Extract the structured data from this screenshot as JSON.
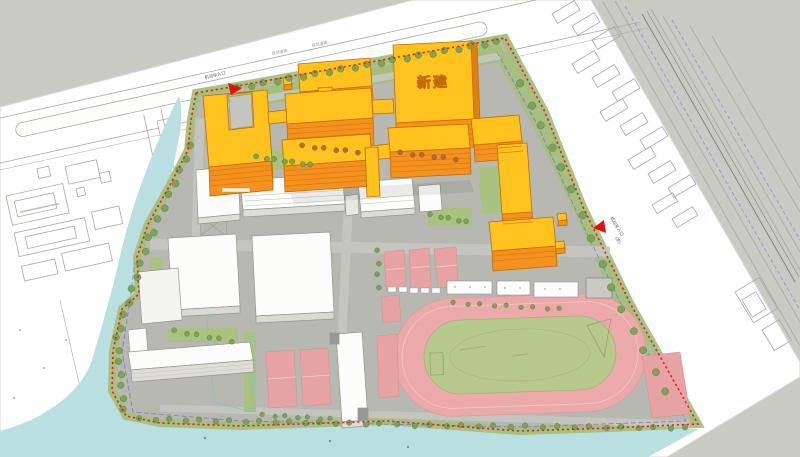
{
  "plan": {
    "type": "campus-master-plan-axonometric",
    "labels": {
      "new_building": "新建",
      "entrance_top": "机动车入口",
      "road_label_1": "规划道路",
      "road_label_2": "规划道路",
      "entrance_right": "机动车入口",
      "entrance_right_note": "(次)"
    },
    "colors": {
      "canvas_background": "#c9cac4",
      "paper": "#ffffff",
      "new_building_roof": "#ffc21e",
      "new_building_wall": "#f5911e",
      "existing_building": "#fcfcfa",
      "site_ground": "#b7b8b2",
      "water": "#b9dfe1",
      "track_ring": "#eba9a9",
      "track_infield": "#b6c88c",
      "courts": "#e7a3a3",
      "greenery": "#a5bf7b",
      "boundary_line": "#e02222",
      "setback_line": "#7b74cf"
    }
  }
}
